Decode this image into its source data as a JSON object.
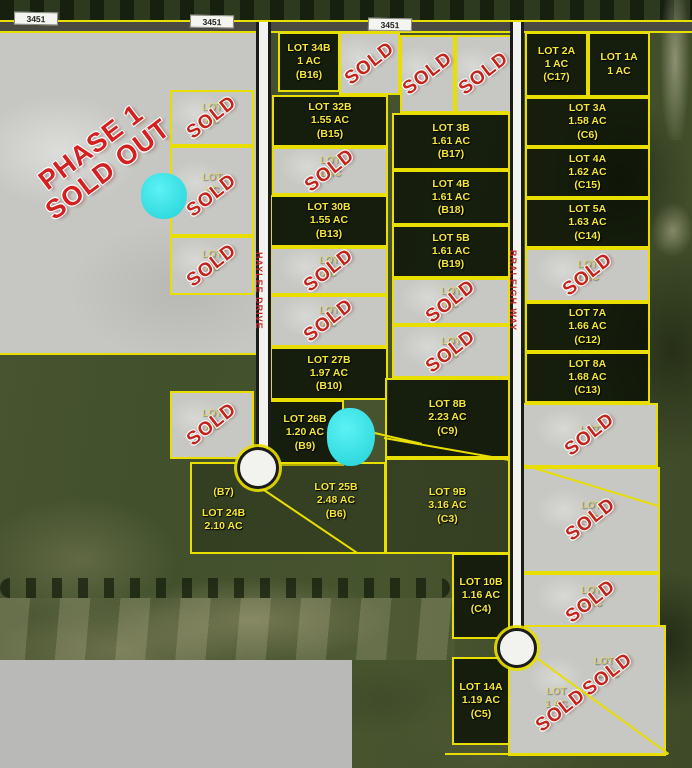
{
  "map": {
    "phase1_label": {
      "line1": "PHASE 1",
      "line2": "SOLD OUT"
    },
    "sold_stamp_text": "SOLD",
    "highway_labels": [
      "3451",
      "3451",
      "3451"
    ],
    "streets": [
      {
        "name": "HAYLEE DRIVE"
      },
      {
        "name": "BRALEIGH WAY"
      }
    ],
    "colors": {
      "boundary": "#e8df00",
      "lot_label": "#f2e637",
      "sold_red": "#c3241c",
      "sold_fill": "#c7c8c3",
      "water": "#35e3e8",
      "road_fill": "#f2f2ee",
      "street_name": "#c22a2a",
      "phase1_fill": "#c6c7c2"
    },
    "lots": [
      {
        "id": "lot-34b",
        "status": "available",
        "x": 278,
        "y": 32,
        "w": 62,
        "h": 60,
        "lines": [
          "LOT 34B",
          "1 AC",
          "(B16)"
        ]
      },
      {
        "id": "lot-32b",
        "status": "available",
        "x": 272,
        "y": 95,
        "w": 116,
        "h": 52,
        "lines": [
          "LOT 32B",
          "1.55 AC",
          "(B15)"
        ]
      },
      {
        "id": "lot-30b",
        "status": "available",
        "x": 270,
        "y": 195,
        "w": 118,
        "h": 52,
        "lines": [
          "LOT 30B",
          "1.55 AC",
          "(B13)"
        ]
      },
      {
        "id": "lot-27b",
        "status": "available",
        "x": 270,
        "y": 347,
        "w": 118,
        "h": 53,
        "lines": [
          "LOT 27B",
          "1.97 AC",
          "(B10)"
        ]
      },
      {
        "id": "lot-26b",
        "status": "available",
        "x": 266,
        "y": 400,
        "w": 78,
        "h": 66,
        "lines": [
          "LOT 26B",
          "1.20 AC",
          "(B9)"
        ]
      },
      {
        "id": "lot-3b",
        "status": "available",
        "x": 392,
        "y": 113,
        "w": 118,
        "h": 57,
        "lines": [
          "LOT 3B",
          "1.61 AC",
          "(B17)"
        ]
      },
      {
        "id": "lot-4b",
        "status": "available",
        "x": 392,
        "y": 170,
        "w": 118,
        "h": 55,
        "lines": [
          "LOT 4B",
          "1.61 AC",
          "(B18)"
        ]
      },
      {
        "id": "lot-5b",
        "status": "available",
        "x": 392,
        "y": 225,
        "w": 118,
        "h": 53,
        "lines": [
          "LOT 5B",
          "1.61 AC",
          "(B19)"
        ]
      },
      {
        "id": "lot-8b",
        "status": "available",
        "x": 385,
        "y": 378,
        "w": 125,
        "h": 80,
        "lines": [
          "LOT 8B",
          "2.23 AC",
          "(C9)"
        ]
      },
      {
        "id": "lot-9b",
        "status": "open",
        "x": 385,
        "y": 458,
        "w": 125,
        "h": 96,
        "lines": [
          "LOT 9B",
          "3.16 AC",
          "(C3)"
        ]
      },
      {
        "id": "lot-10b",
        "status": "available",
        "x": 452,
        "y": 553,
        "w": 58,
        "h": 86,
        "lines": [
          "LOT 10B",
          "1.16 AC",
          "(C4)"
        ]
      },
      {
        "id": "lot-14a",
        "status": "available",
        "x": 452,
        "y": 657,
        "w": 58,
        "h": 88,
        "lines": [
          "LOT 14A",
          "1.19 AC",
          "(C5)"
        ]
      },
      {
        "id": "lot-24b",
        "status": "open",
        "x": 190,
        "y": 462,
        "w": 196,
        "h": 92,
        "labelpos": "left",
        "lines": [
          "(B7)",
          "LOT 24B",
          "2.10 AC"
        ]
      },
      {
        "id": "lot-25b",
        "status": "label-only",
        "x": 286,
        "y": 466,
        "w": 100,
        "h": 70,
        "lines": [
          "LOT 25B",
          "2.48 AC",
          "(B6)"
        ]
      },
      {
        "id": "lot-2a",
        "status": "available",
        "x": 525,
        "y": 32,
        "w": 63,
        "h": 65,
        "lines": [
          "LOT 2A",
          "1 AC",
          "(C17)"
        ]
      },
      {
        "id": "lot-1a",
        "status": "available",
        "x": 588,
        "y": 32,
        "w": 62,
        "h": 65,
        "lines": [
          "LOT 1A",
          "1 AC"
        ]
      },
      {
        "id": "lot-3a",
        "status": "available",
        "x": 525,
        "y": 97,
        "w": 125,
        "h": 50,
        "lines": [
          "LOT 3A",
          "1.58 AC",
          "(C6)"
        ]
      },
      {
        "id": "lot-4a",
        "status": "available",
        "x": 525,
        "y": 147,
        "w": 125,
        "h": 51,
        "lines": [
          "LOT 4A",
          "1.62 AC",
          "(C15)"
        ]
      },
      {
        "id": "lot-5a",
        "status": "available",
        "x": 525,
        "y": 198,
        "w": 125,
        "h": 50,
        "lines": [
          "LOT 5A",
          "1.63 AC",
          "(C14)"
        ]
      },
      {
        "id": "lot-7a",
        "status": "available",
        "x": 525,
        "y": 302,
        "w": 125,
        "h": 50,
        "lines": [
          "LOT 7A",
          "1.66 AC",
          "(C12)"
        ]
      },
      {
        "id": "lot-8a",
        "status": "available",
        "x": 525,
        "y": 352,
        "w": 125,
        "h": 51,
        "lines": [
          "LOT 8A",
          "1.68 AC",
          "(C13)"
        ]
      },
      {
        "id": "lot-sold-left-1",
        "status": "sold",
        "x": 170,
        "y": 90,
        "w": 84,
        "h": 56,
        "faint": [
          "LOT",
          "AC"
        ]
      },
      {
        "id": "lot-sold-left-2",
        "status": "sold",
        "x": 170,
        "y": 146,
        "w": 84,
        "h": 90,
        "faint": [
          "LOT",
          "AC"
        ]
      },
      {
        "id": "lot-sold-left-3",
        "status": "sold",
        "x": 170,
        "y": 236,
        "w": 84,
        "h": 59,
        "faint": [
          "LOT",
          "AC"
        ]
      },
      {
        "id": "lot-sold-left-4",
        "status": "sold",
        "x": 170,
        "y": 391,
        "w": 84,
        "h": 68,
        "faint": [
          "LOT",
          "AC"
        ]
      },
      {
        "id": "lot-sold-top-1",
        "status": "sold",
        "x": 339,
        "y": 32,
        "w": 61,
        "h": 63,
        "faint": []
      },
      {
        "id": "lot-sold-top-2",
        "status": "sold",
        "x": 400,
        "y": 35,
        "w": 55,
        "h": 78,
        "faint": []
      },
      {
        "id": "lot-sold-top-3",
        "status": "sold",
        "x": 455,
        "y": 35,
        "w": 57,
        "h": 78,
        "faint": []
      },
      {
        "id": "lot-sold-b-1",
        "status": "sold",
        "x": 272,
        "y": 147,
        "w": 116,
        "h": 48,
        "faint": [
          "LOT",
          "1 AC"
        ]
      },
      {
        "id": "lot-sold-b-2",
        "status": "sold",
        "x": 270,
        "y": 247,
        "w": 118,
        "h": 48,
        "faint": [
          "LOT",
          "AC"
        ]
      },
      {
        "id": "lot-sold-b-3",
        "status": "sold",
        "x": 270,
        "y": 295,
        "w": 118,
        "h": 52,
        "faint": [
          "LOT",
          "AC"
        ]
      },
      {
        "id": "lot-sold-mid-1",
        "status": "sold",
        "x": 392,
        "y": 278,
        "w": 118,
        "h": 47,
        "faint": [
          "LOT",
          "AC"
        ]
      },
      {
        "id": "lot-sold-mid-2",
        "status": "sold",
        "x": 392,
        "y": 325,
        "w": 118,
        "h": 53,
        "faint": [
          "LOT",
          "AC"
        ]
      },
      {
        "id": "lot-sold-right-1",
        "status": "sold",
        "x": 525,
        "y": 248,
        "w": 125,
        "h": 54,
        "faint": [
          "LOT",
          "1 AC"
        ]
      },
      {
        "id": "lot-sold-right-2",
        "status": "sold",
        "x": 522,
        "y": 403,
        "w": 136,
        "h": 64,
        "faint": [
          "LOT"
        ]
      },
      {
        "id": "lot-sold-right-3",
        "status": "sold",
        "x": 522,
        "y": 467,
        "w": 138,
        "h": 106,
        "faint": [
          "LOT",
          "AC"
        ]
      },
      {
        "id": "lot-sold-right-4",
        "status": "sold",
        "x": 522,
        "y": 573,
        "w": 138,
        "h": 57,
        "faint": [
          "LOT",
          "2 AC"
        ]
      },
      {
        "id": "lot-sold-corner-lower",
        "status": "sold",
        "x": 508,
        "y": 625,
        "w": 158,
        "h": 131,
        "faint": [
          "LOT",
          "1 AC"
        ]
      },
      {
        "id": "lot-sold-corner-upper",
        "status": "sold",
        "x": 556,
        "y": 632,
        "w": 104,
        "h": 85,
        "faint": [
          "LOT 1",
          "2 AC"
        ]
      }
    ]
  }
}
